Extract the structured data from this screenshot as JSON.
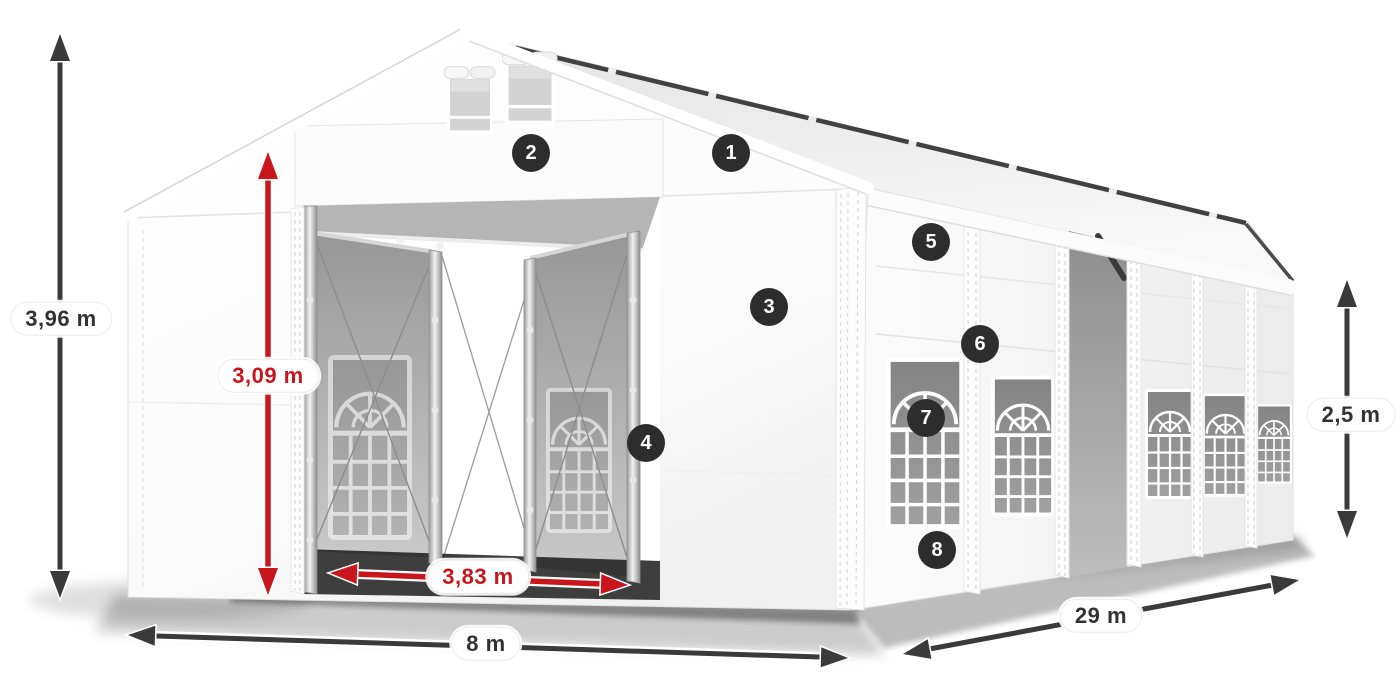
{
  "page": {
    "description": "Isometric product dimension diagram of a white party tent with open front doors, arched side windows and numbered feature callouts",
    "background": "#ffffff"
  },
  "colors": {
    "dim_dark": "#3a3a3a",
    "dim_red": "#c9161c",
    "pill_bg": "#ffffff",
    "pill_text_dark": "#323232",
    "marker_bg": "#2d2d2d",
    "marker_text": "#ffffff",
    "tent_white": "#ffffff",
    "window_glass": "#8f8f8f"
  },
  "dimensions": {
    "total_height": {
      "label": "3,96 m",
      "style": "dark",
      "orientation": "vertical"
    },
    "door_height": {
      "label": "3,09 m",
      "style": "red",
      "orientation": "vertical"
    },
    "door_width": {
      "label": "3,83 m",
      "style": "red",
      "orientation": "horizontal"
    },
    "front_width": {
      "label": "8 m",
      "style": "dark",
      "orientation": "horizontal"
    },
    "length": {
      "label": "29 m",
      "style": "dark",
      "orientation": "diagonal"
    },
    "side_height": {
      "label": "2,5 m",
      "style": "dark",
      "orientation": "vertical"
    }
  },
  "markers": [
    {
      "number": "1",
      "x": 731,
      "y": 153
    },
    {
      "number": "2",
      "x": 531,
      "y": 153
    },
    {
      "number": "3",
      "x": 769,
      "y": 307
    },
    {
      "number": "4",
      "x": 646,
      "y": 443
    },
    {
      "number": "5",
      "x": 931,
      "y": 242
    },
    {
      "number": "6",
      "x": 980,
      "y": 344
    },
    {
      "number": "7",
      "x": 926,
      "y": 418
    },
    {
      "number": "8",
      "x": 937,
      "y": 550
    }
  ]
}
